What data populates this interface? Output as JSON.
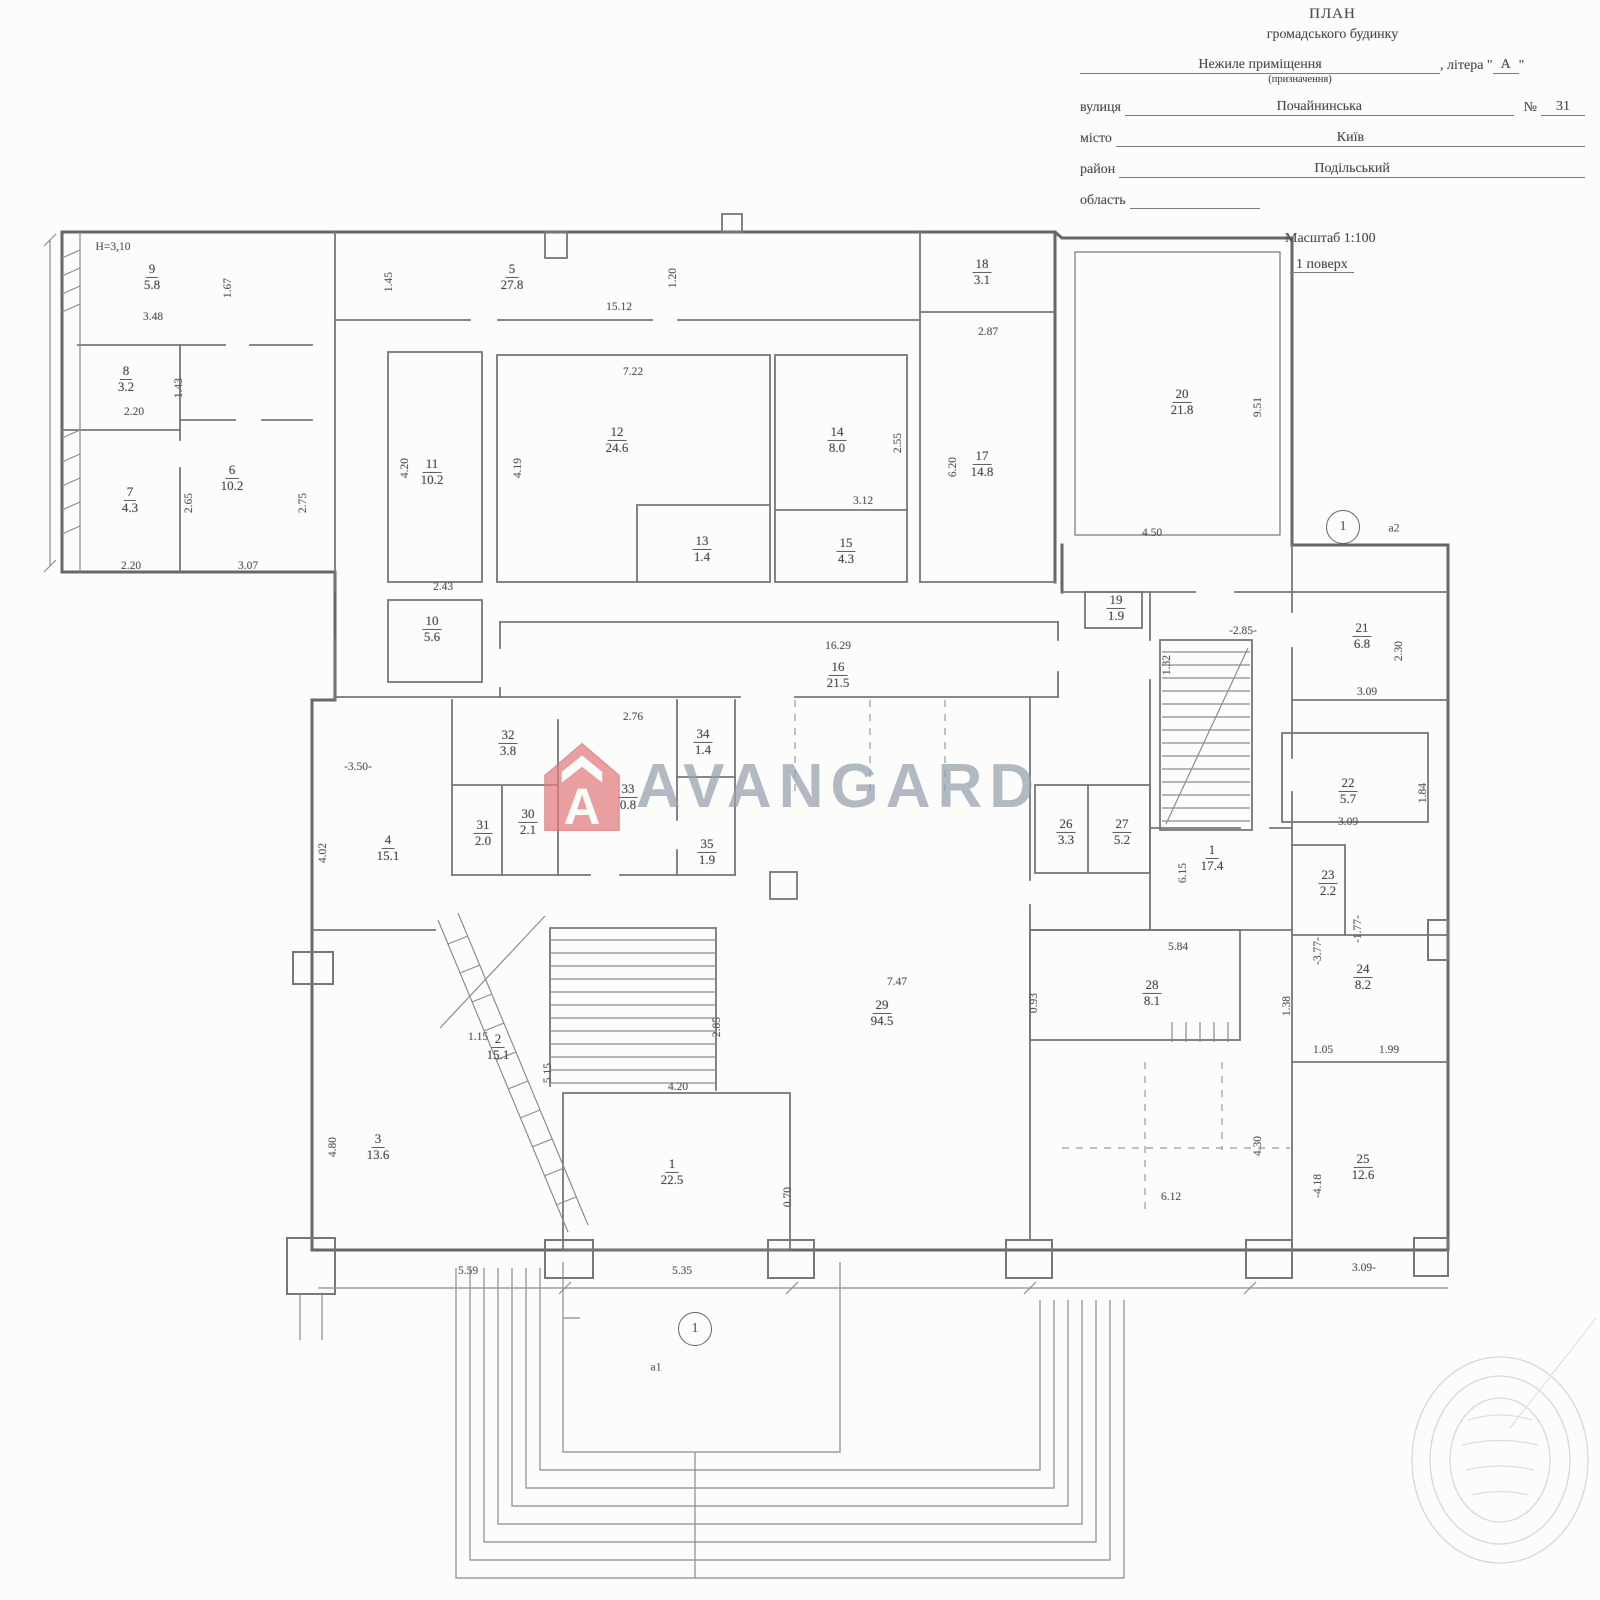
{
  "header": {
    "title": "ПЛАН",
    "subtitle": "громадського будинку",
    "premise_value": "Нежиле приміщення",
    "premise_note": "(призначення)",
    "letter_pre": ", літера \" ",
    "letter_value": "А",
    "letter_post": " \"",
    "street_label": "вулиця",
    "street_value": "Почайнинська",
    "number_label": "№",
    "number_value": "31",
    "city_label": "місто",
    "city_value": "Київ",
    "district_label": "район",
    "district_value": "Подільський",
    "region_label": "область",
    "region_value": "",
    "scale": "Масштаб 1:100",
    "floor": "1 поверх"
  },
  "watermark": {
    "brand": "AVANGARD",
    "logo_letter": "A",
    "logo_color": "#e07a7d",
    "brand_color": "#94a1ad"
  },
  "plan": {
    "rooms": [
      {
        "n": "9",
        "a": "5.8",
        "x": 152,
        "y": 277
      },
      {
        "n": "8",
        "a": "3.2",
        "x": 126,
        "y": 379
      },
      {
        "n": "7",
        "a": "4.3",
        "x": 130,
        "y": 500
      },
      {
        "n": "6",
        "a": "10.2",
        "x": 232,
        "y": 478
      },
      {
        "n": "5",
        "a": "27.8",
        "x": 512,
        "y": 277
      },
      {
        "n": "11",
        "a": "10.2",
        "x": 432,
        "y": 472
      },
      {
        "n": "12",
        "a": "24.6",
        "x": 617,
        "y": 440
      },
      {
        "n": "13",
        "a": "1.4",
        "x": 702,
        "y": 549
      },
      {
        "n": "14",
        "a": "8.0",
        "x": 837,
        "y": 440
      },
      {
        "n": "15",
        "a": "4.3",
        "x": 846,
        "y": 551
      },
      {
        "n": "18",
        "a": "3.1",
        "x": 982,
        "y": 272
      },
      {
        "n": "17",
        "a": "14.8",
        "x": 982,
        "y": 464
      },
      {
        "n": "20",
        "a": "21.8",
        "x": 1182,
        "y": 402
      },
      {
        "n": "19",
        "a": "1.9",
        "x": 1116,
        "y": 608
      },
      {
        "n": "16",
        "a": "21.5",
        "x": 838,
        "y": 675
      },
      {
        "n": "21",
        "a": "6.8",
        "x": 1362,
        "y": 636
      },
      {
        "n": "22",
        "a": "5.7",
        "x": 1348,
        "y": 791
      },
      {
        "n": "23",
        "a": "2.2",
        "x": 1328,
        "y": 883
      },
      {
        "n": "24",
        "a": "8.2",
        "x": 1363,
        "y": 977
      },
      {
        "n": "25",
        "a": "12.6",
        "x": 1363,
        "y": 1167
      },
      {
        "n": "26",
        "a": "3.3",
        "x": 1066,
        "y": 832
      },
      {
        "n": "27",
        "a": "5.2",
        "x": 1122,
        "y": 832
      },
      {
        "n": "1",
        "a": "17.4",
        "x": 1212,
        "y": 858
      },
      {
        "n": "28",
        "a": "8.1",
        "x": 1152,
        "y": 993
      },
      {
        "n": "29",
        "a": "94.5",
        "x": 882,
        "y": 1013
      },
      {
        "n": "30",
        "a": "2.1",
        "x": 528,
        "y": 822
      },
      {
        "n": "31",
        "a": "2.0",
        "x": 483,
        "y": 833
      },
      {
        "n": "32",
        "a": "3.8",
        "x": 508,
        "y": 743
      },
      {
        "n": "33",
        "a": "0.8",
        "x": 628,
        "y": 797
      },
      {
        "n": "34",
        "a": "1.4",
        "x": 703,
        "y": 742
      },
      {
        "n": "35",
        "a": "1.9",
        "x": 707,
        "y": 852
      },
      {
        "n": "4",
        "a": "15.1",
        "x": 388,
        "y": 848
      },
      {
        "n": "2",
        "a": "15.1",
        "x": 498,
        "y": 1047
      },
      {
        "n": "3",
        "a": "13.6",
        "x": 378,
        "y": 1147
      },
      {
        "n": "1",
        "a": "22.5",
        "x": 672,
        "y": 1172
      },
      {
        "n": "10",
        "a": "5.6",
        "x": 432,
        "y": 629
      }
    ],
    "dims": [
      {
        "t": "Н=3,10",
        "x": 113,
        "y": 247,
        "r": 0
      },
      {
        "t": "1.67",
        "x": 228,
        "y": 288,
        "r": 90
      },
      {
        "t": "3.48",
        "x": 153,
        "y": 317,
        "r": 0
      },
      {
        "t": "2.20",
        "x": 134,
        "y": 412,
        "r": 0
      },
      {
        "t": "1.43",
        "x": 179,
        "y": 388,
        "r": 90
      },
      {
        "t": "2.65",
        "x": 189,
        "y": 503,
        "r": 90
      },
      {
        "t": "2.75",
        "x": 303,
        "y": 503,
        "r": 90
      },
      {
        "t": "2.20",
        "x": 131,
        "y": 566,
        "r": 0
      },
      {
        "t": "3.07",
        "x": 248,
        "y": 566,
        "r": 0
      },
      {
        "t": "1.45",
        "x": 389,
        "y": 282,
        "r": 90
      },
      {
        "t": "15.12",
        "x": 619,
        "y": 307,
        "r": 0
      },
      {
        "t": "1.20",
        "x": 673,
        "y": 278,
        "r": 90
      },
      {
        "t": "2.87",
        "x": 988,
        "y": 332,
        "r": 0
      },
      {
        "t": "7.22",
        "x": 633,
        "y": 372,
        "r": 0
      },
      {
        "t": "4.20",
        "x": 405,
        "y": 468,
        "r": 90
      },
      {
        "t": "4.19",
        "x": 518,
        "y": 468,
        "r": 90
      },
      {
        "t": "2.43",
        "x": 443,
        "y": 587,
        "r": 0
      },
      {
        "t": "2.55",
        "x": 898,
        "y": 443,
        "r": 90
      },
      {
        "t": "3.12",
        "x": 863,
        "y": 501,
        "r": 0
      },
      {
        "t": "6.20",
        "x": 953,
        "y": 467,
        "r": 90
      },
      {
        "t": "9.51",
        "x": 1258,
        "y": 407,
        "r": 90
      },
      {
        "t": "4.50",
        "x": 1152,
        "y": 533,
        "r": 0
      },
      {
        "t": "16.29",
        "x": 838,
        "y": 646,
        "r": 0
      },
      {
        "t": "1.32",
        "x": 1167,
        "y": 665,
        "r": 90
      },
      {
        "t": "-2.85-",
        "x": 1243,
        "y": 631,
        "r": 0
      },
      {
        "t": "2.30",
        "x": 1399,
        "y": 651,
        "r": 90
      },
      {
        "t": "3.09",
        "x": 1367,
        "y": 692,
        "r": 0
      },
      {
        "t": "1.84",
        "x": 1423,
        "y": 793,
        "r": 90
      },
      {
        "t": "3.09",
        "x": 1348,
        "y": 822,
        "r": 0
      },
      {
        "t": "2.76",
        "x": 633,
        "y": 717,
        "r": 0
      },
      {
        "t": "-3.50-",
        "x": 358,
        "y": 767,
        "r": 0
      },
      {
        "t": "4.02",
        "x": 323,
        "y": 853,
        "r": 90
      },
      {
        "t": "6.15",
        "x": 1183,
        "y": 873,
        "r": 90
      },
      {
        "t": "-3.77-",
        "x": 1318,
        "y": 951,
        "r": 90
      },
      {
        "t": "-1.77-",
        "x": 1358,
        "y": 929,
        "r": 90
      },
      {
        "t": "5.84",
        "x": 1178,
        "y": 947,
        "r": 0
      },
      {
        "t": "1.38",
        "x": 1287,
        "y": 1006,
        "r": 90
      },
      {
        "t": "1.05",
        "x": 1323,
        "y": 1050,
        "r": 0
      },
      {
        "t": "1.99",
        "x": 1389,
        "y": 1050,
        "r": 0
      },
      {
        "t": "0.93",
        "x": 1034,
        "y": 1003,
        "r": 90
      },
      {
        "t": "7.47",
        "x": 897,
        "y": 982,
        "r": 0
      },
      {
        "t": "1.15",
        "x": 478,
        "y": 1037,
        "r": 0
      },
      {
        "t": "5.15",
        "x": 548,
        "y": 1073,
        "r": 90
      },
      {
        "t": "4.20",
        "x": 678,
        "y": 1087,
        "r": 0
      },
      {
        "t": "2.85",
        "x": 717,
        "y": 1027,
        "r": 90
      },
      {
        "t": "4.80",
        "x": 333,
        "y": 1147,
        "r": 90
      },
      {
        "t": "5.59",
        "x": 468,
        "y": 1271,
        "r": 0
      },
      {
        "t": "5.35",
        "x": 682,
        "y": 1271,
        "r": 0
      },
      {
        "t": "0.70",
        "x": 788,
        "y": 1197,
        "r": 90
      },
      {
        "t": "4.30",
        "x": 1258,
        "y": 1146,
        "r": 90
      },
      {
        "t": "6.12",
        "x": 1171,
        "y": 1197,
        "r": 0
      },
      {
        "t": "-4.18",
        "x": 1318,
        "y": 1186,
        "r": 90
      },
      {
        "t": "3.09-",
        "x": 1364,
        "y": 1268,
        "r": 0
      }
    ],
    "axes": [
      {
        "n": "1",
        "x": 1343,
        "y": 527,
        "t": "а2",
        "tx": 1394,
        "ty": 528
      },
      {
        "n": "1",
        "x": 695,
        "y": 1329,
        "t": "а1",
        "tx": 656,
        "ty": 1367
      }
    ]
  }
}
